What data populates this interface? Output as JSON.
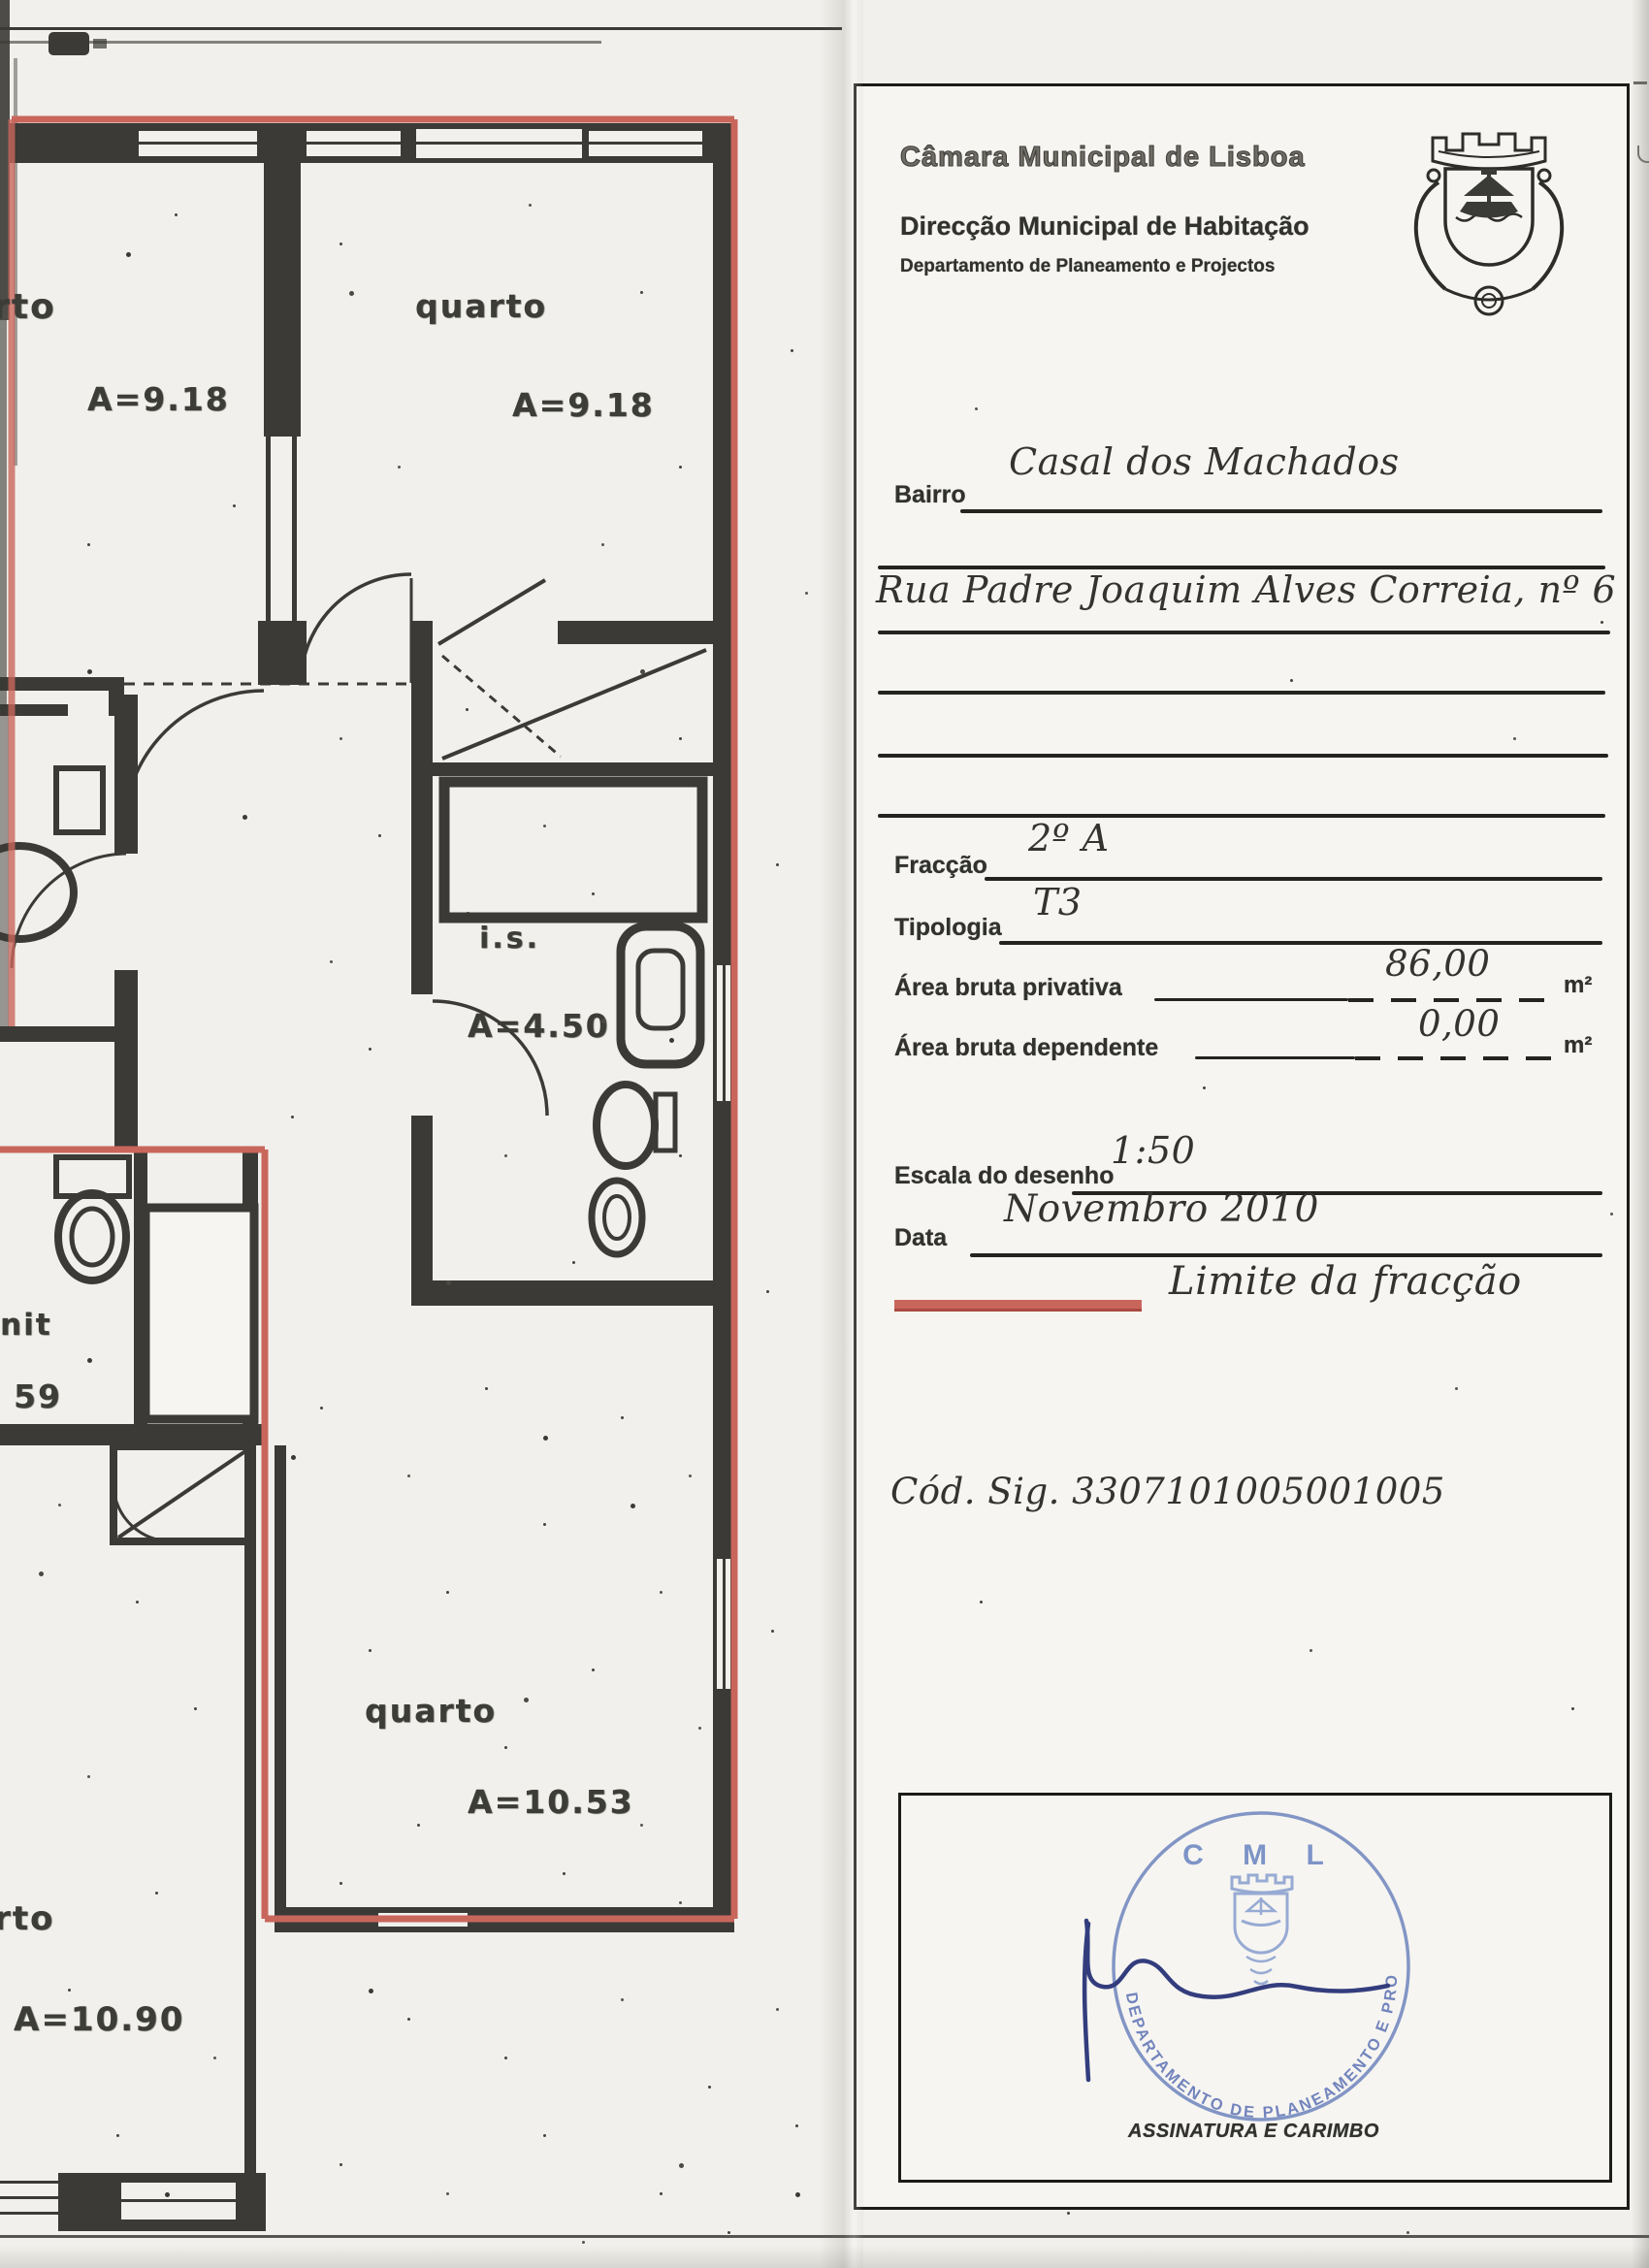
{
  "header": {
    "org1": "Câmara Municipal de Lisboa",
    "org2": "Direcção Municipal de Habitação",
    "org3": "Departamento de Planeamento e Projectos"
  },
  "form": {
    "bairro_label": "Bairro",
    "bairro_value": "Casal dos Machados",
    "address_value": "Rua Padre Joaquim Alves Correia, nº 6",
    "fraccao_label": "Fracção",
    "fraccao_value": "2º A",
    "tipologia_label": "Tipologia",
    "tipologia_value": "T3",
    "area_privativa_label": "Área bruta privativa",
    "area_privativa_value": "86,00",
    "area_privativa_unit": "m²",
    "area_dependente_label": "Área bruta dependente",
    "area_dependente_value": "0,00",
    "area_dependente_unit": "m²",
    "escala_label": "Escala do desenho",
    "escala_value": "1:50",
    "data_label": "Data",
    "data_value": "Novembro 2010",
    "legend_label": "Limite da fracção",
    "cod_sig": "Cód. Sig. 3307101005001005",
    "signature_caption": "ASSINATURA E CARIMBO",
    "stamp": {
      "top": "C M L",
      "ring": "DEPARTAMENTO DE PLANEAMENTO E PROJECTOS"
    }
  },
  "floorplan": {
    "labels": {
      "room_tl_partial": "rto",
      "room_tl_area": "A=9.18",
      "room_tr": "quarto",
      "room_tr_area": "A=9.18",
      "bathroom": "i.s.",
      "bathroom_area": "A=4.50",
      "room_mid": "quarto",
      "room_mid_area": "A=10.53",
      "fragment_nit": "nit",
      "fragment_59": "59",
      "room_bl_partial": "rto",
      "room_bl_area": "A=10.90"
    },
    "colors": {
      "boundary_red": "#c9665c",
      "wall": "#3b3a36",
      "stamp_blue": "#6d87c2",
      "signature_blue": "#333d7d"
    }
  }
}
